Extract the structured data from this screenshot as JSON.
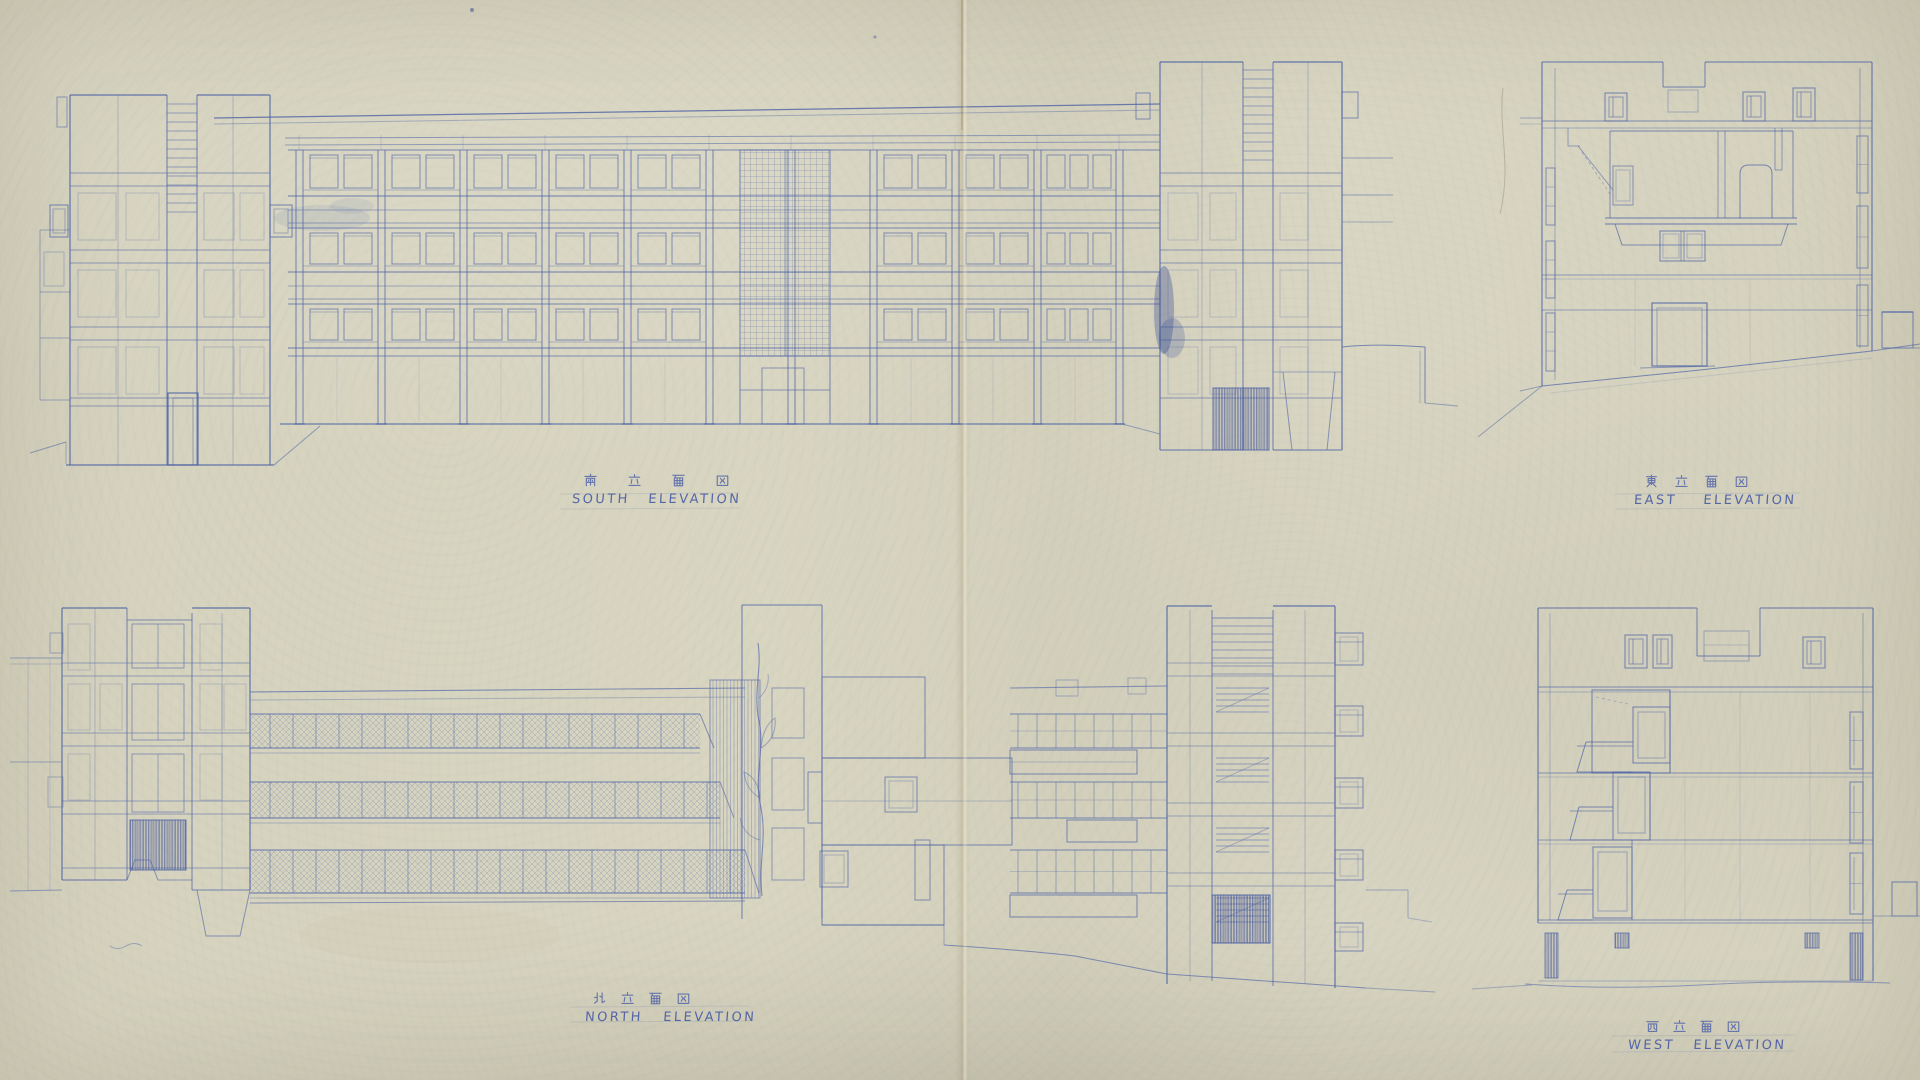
{
  "colors": {
    "paper": "#d7d4c0",
    "ink": "#4d63a5",
    "ink_dark": "#2f4390",
    "crease": "#b89a6c",
    "label_ink": "#4a5ea6"
  },
  "elevations": [
    {
      "id": "south",
      "label_jp": "南立面図",
      "label_en": "SOUTH ELEVATION"
    },
    {
      "id": "east",
      "label_jp": "東立面図",
      "label_en": "EAST ELEVATION"
    },
    {
      "id": "north",
      "label_jp": "北立面図",
      "label_en": "NORTH ELEVATION"
    },
    {
      "id": "west",
      "label_jp": "西立面図",
      "label_en": "WEST ELEVATION"
    }
  ]
}
